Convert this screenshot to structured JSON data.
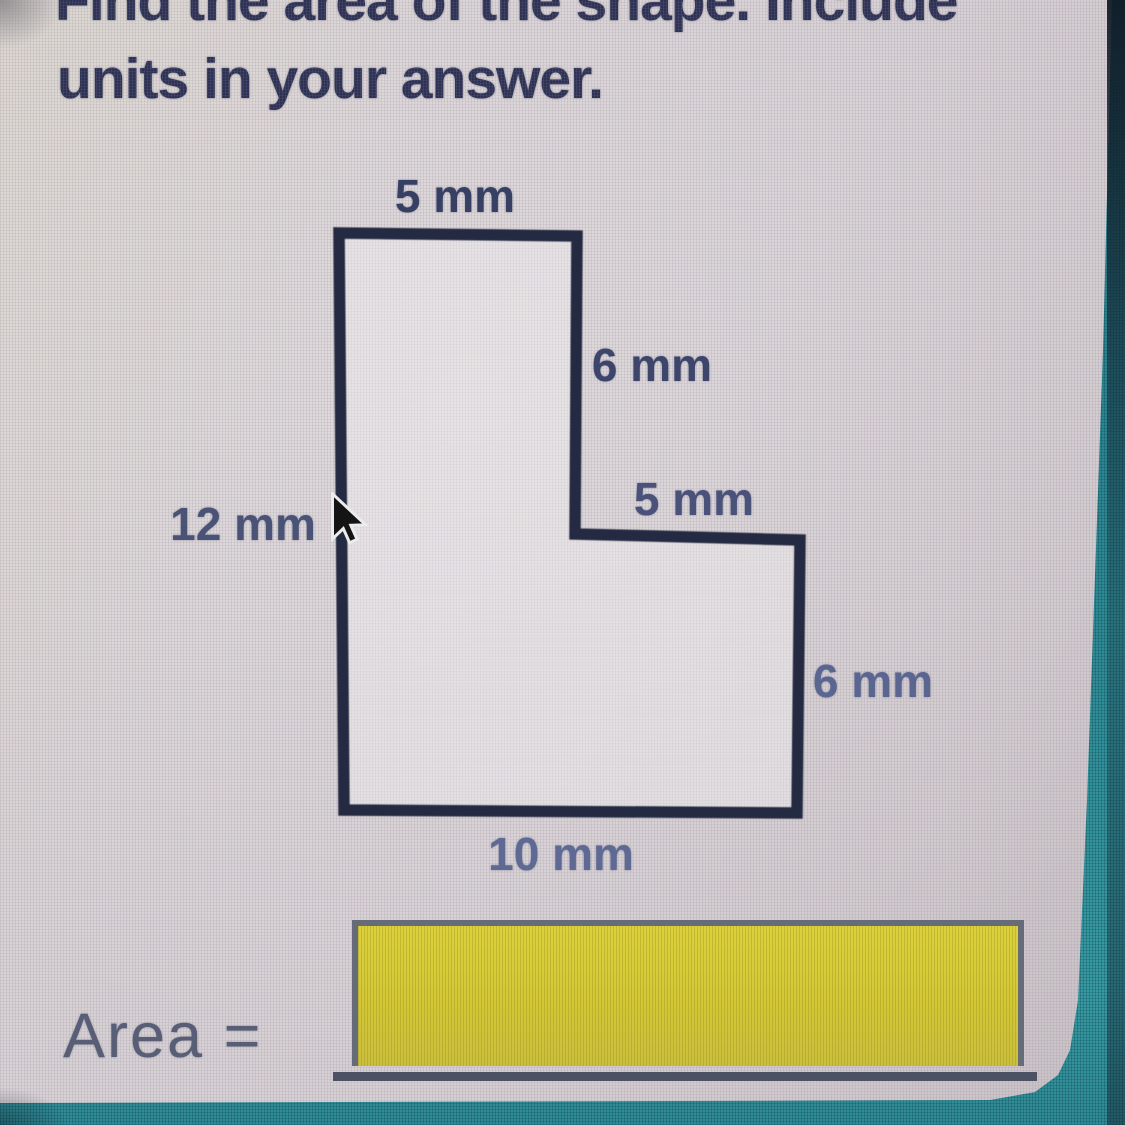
{
  "question": {
    "instruction_line1": "Find the area of the shape. Include",
    "instruction_line2": "units in your answer."
  },
  "figure": {
    "dimension_labels": {
      "top": "5 mm",
      "right_upper": "6 mm",
      "step": "5 mm",
      "left": "12 mm",
      "right_lower": "6 mm",
      "bottom": "10 mm"
    }
  },
  "answer": {
    "label": "Area =",
    "input_value": ""
  },
  "cursor": {
    "type": "arrow-pointer"
  },
  "colors": {
    "headline_ink": "#2c3254",
    "dimension_ink": "#49527a",
    "answer_label_ink": "#575e76",
    "shape_stroke": "#232a41",
    "input_fill": "#d3c736",
    "input_border": "#666b78",
    "frame_teal": "#2e8a95",
    "panel_background": "#d5d0d3"
  }
}
